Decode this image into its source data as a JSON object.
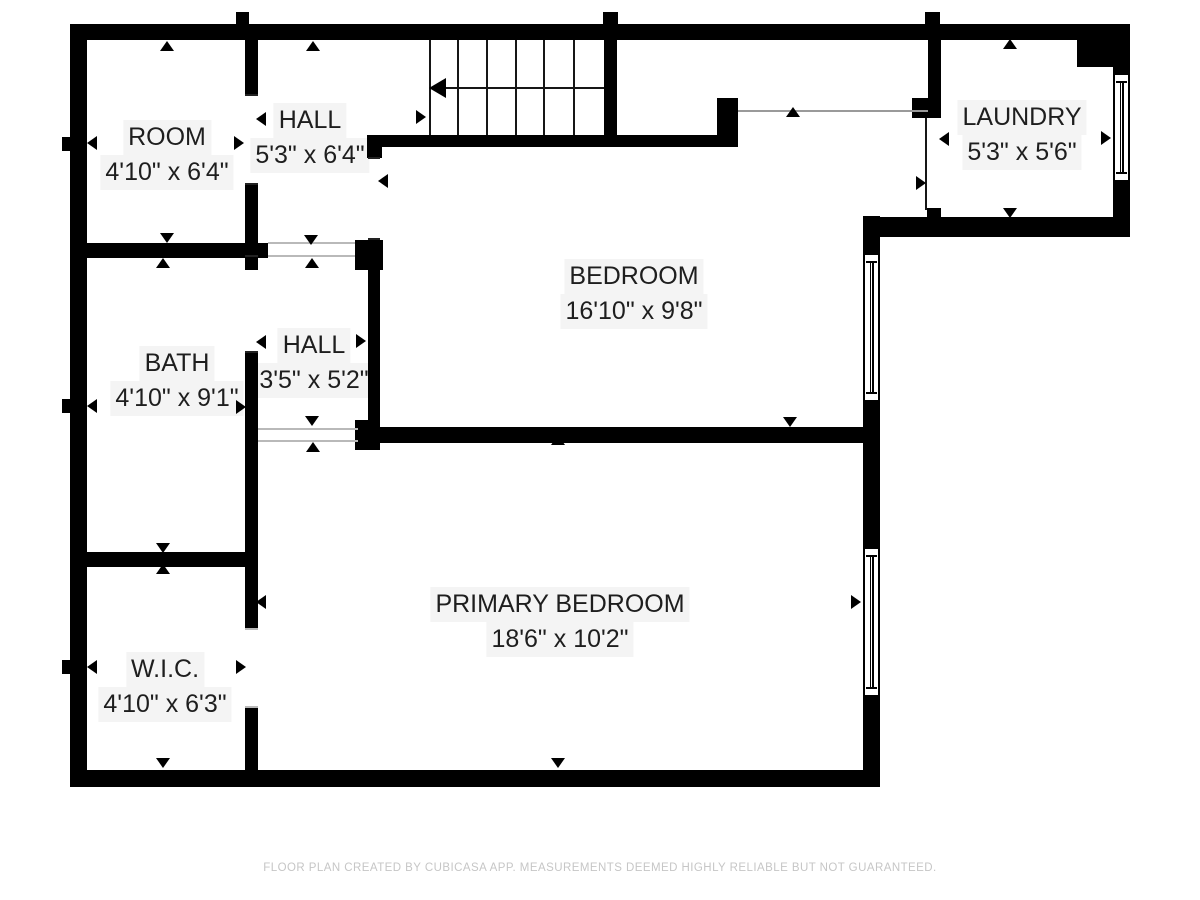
{
  "canvas": {
    "width": 1200,
    "height": 900,
    "background": "#ffffff",
    "wall_color": "#000000",
    "label_color": "#1e1e1e",
    "muted_color": "#c6c6c6"
  },
  "footer": {
    "text": "FLOOR PLAN CREATED BY CUBICASA APP. MEASUREMENTS DEEMED HIGHLY RELIABLE BUT NOT GUARANTEED.",
    "y": 862
  },
  "rooms": [
    {
      "id": "room",
      "name": "ROOM",
      "dims": "4'10\" x 6'4\"",
      "cx": 167,
      "cy": 155
    },
    {
      "id": "hall-upper",
      "name": "HALL",
      "dims": "5'3\" x 6'4\"",
      "cx": 310,
      "cy": 138
    },
    {
      "id": "laundry",
      "name": "LAUNDRY",
      "dims": "5'3\" x 5'6\"",
      "cx": 1022,
      "cy": 135
    },
    {
      "id": "bedroom",
      "name": "BEDROOM",
      "dims": "16'10\" x 9'8\"",
      "cx": 634,
      "cy": 294
    },
    {
      "id": "bath",
      "name": "BATH",
      "dims": "4'10\" x 9'1\"",
      "cx": 177,
      "cy": 381
    },
    {
      "id": "hall-lower",
      "name": "HALL",
      "dims": "3'5\" x 5'2\"",
      "cx": 314,
      "cy": 363
    },
    {
      "id": "wic",
      "name": "W.I.C.",
      "dims": "4'10\" x 6'3\"",
      "cx": 165,
      "cy": 687
    },
    {
      "id": "primary-bedroom",
      "name": "PRIMARY BEDROOM",
      "dims": "18'6\" x 10'2\"",
      "cx": 560,
      "cy": 622
    }
  ],
  "walls": [
    {
      "x": 70,
      "y": 24,
      "w": 1060,
      "h": 16
    },
    {
      "x": 70,
      "y": 24,
      "w": 17,
      "h": 763
    },
    {
      "x": 70,
      "y": 770,
      "w": 810,
      "h": 17
    },
    {
      "x": 863,
      "y": 216,
      "w": 17,
      "h": 554
    },
    {
      "x": 863,
      "y": 217,
      "w": 267,
      "h": 20
    },
    {
      "x": 1113,
      "y": 40,
      "w": 17,
      "h": 197
    },
    {
      "x": 1077,
      "y": 40,
      "w": 53,
      "h": 27
    },
    {
      "x": 245,
      "y": 40,
      "w": 13,
      "h": 55
    },
    {
      "x": 245,
      "y": 185,
      "w": 13,
      "h": 85
    },
    {
      "x": 70,
      "y": 243,
      "w": 198,
      "h": 15
    },
    {
      "x": 355,
      "y": 240,
      "w": 28,
      "h": 30
    },
    {
      "x": 245,
      "y": 353,
      "w": 13,
      "h": 214
    },
    {
      "x": 70,
      "y": 552,
      "w": 188,
      "h": 15
    },
    {
      "x": 245,
      "y": 567,
      "w": 13,
      "h": 63
    },
    {
      "x": 245,
      "y": 708,
      "w": 13,
      "h": 79
    },
    {
      "x": 368,
      "y": 240,
      "w": 12,
      "h": 187
    },
    {
      "x": 367,
      "y": 135,
      "w": 15,
      "h": 23
    },
    {
      "x": 367,
      "y": 135,
      "w": 350,
      "h": 12
    },
    {
      "x": 604,
      "y": 40,
      "w": 13,
      "h": 107
    },
    {
      "x": 717,
      "y": 98,
      "w": 21,
      "h": 49
    },
    {
      "x": 928,
      "y": 40,
      "w": 13,
      "h": 58
    },
    {
      "x": 912,
      "y": 98,
      "w": 29,
      "h": 20
    },
    {
      "x": 358,
      "y": 427,
      "w": 505,
      "h": 16
    },
    {
      "x": 355,
      "y": 420,
      "w": 25,
      "h": 30
    },
    {
      "x": 927,
      "y": 208,
      "w": 14,
      "h": 9
    },
    {
      "x": 236,
      "y": 12,
      "w": 13,
      "h": 12
    },
    {
      "x": 603,
      "y": 12,
      "w": 15,
      "h": 12
    },
    {
      "x": 925,
      "y": 12,
      "w": 15,
      "h": 12
    },
    {
      "x": 62,
      "y": 137,
      "w": 8,
      "h": 14
    },
    {
      "x": 62,
      "y": 399,
      "w": 8,
      "h": 14
    },
    {
      "x": 62,
      "y": 660,
      "w": 8,
      "h": 14
    }
  ],
  "lines": [
    {
      "x": 925,
      "y": 118,
      "w": 2,
      "h": 92,
      "c": "#161616"
    },
    {
      "x": 245,
      "y": 94,
      "w": 13,
      "h": 2,
      "c": "#222222"
    },
    {
      "x": 245,
      "y": 183,
      "w": 13,
      "h": 2,
      "c": "#222222"
    },
    {
      "x": 245,
      "y": 255,
      "w": 13,
      "h": 2,
      "c": "#222222"
    },
    {
      "x": 245,
      "y": 351,
      "w": 13,
      "h": 2,
      "c": "#222222"
    },
    {
      "x": 368,
      "y": 157,
      "w": 12,
      "h": 2,
      "c": "#222222"
    },
    {
      "x": 368,
      "y": 238,
      "w": 12,
      "h": 2,
      "c": "#222222"
    }
  ],
  "open_edges": [
    {
      "x": 268,
      "y": 242,
      "w": 87,
      "h": 2,
      "c": "#b9b9b9"
    },
    {
      "x": 268,
      "y": 255,
      "w": 87,
      "h": 2,
      "c": "#b9b9b9"
    },
    {
      "x": 258,
      "y": 428,
      "w": 100,
      "h": 2,
      "c": "#b9b9b9"
    },
    {
      "x": 258,
      "y": 440,
      "w": 100,
      "h": 2,
      "c": "#b9b9b9"
    },
    {
      "x": 738,
      "y": 110,
      "w": 190,
      "h": 2,
      "c": "#9a9a9a"
    },
    {
      "x": 245,
      "y": 628,
      "w": 13,
      "h": 2,
      "c": "#b9b9b9"
    },
    {
      "x": 245,
      "y": 706,
      "w": 13,
      "h": 2,
      "c": "#b9b9b9"
    }
  ],
  "windows": [
    {
      "x": 1113,
      "y": 73,
      "w": 17,
      "h": 109
    },
    {
      "x": 863,
      "y": 253,
      "w": 17,
      "h": 149
    },
    {
      "x": 863,
      "y": 547,
      "w": 17,
      "h": 150
    }
  ],
  "stairs": {
    "x": 429,
    "y": 40,
    "w": 175,
    "h": 95,
    "treads": [
      457,
      486,
      515,
      543,
      573
    ],
    "arrow_y": 88,
    "arrow_x1": 429,
    "arrow_x2": 604
  },
  "arrows": [
    {
      "x": 167,
      "y": 46,
      "d": "up"
    },
    {
      "x": 167,
      "y": 238,
      "d": "down"
    },
    {
      "x": 92,
      "y": 143,
      "d": "left"
    },
    {
      "x": 239,
      "y": 143,
      "d": "right"
    },
    {
      "x": 313,
      "y": 46,
      "d": "up"
    },
    {
      "x": 311,
      "y": 240,
      "d": "down"
    },
    {
      "x": 261,
      "y": 119,
      "d": "left"
    },
    {
      "x": 421,
      "y": 117,
      "d": "right"
    },
    {
      "x": 1010,
      "y": 44,
      "d": "up"
    },
    {
      "x": 1010,
      "y": 213,
      "d": "down"
    },
    {
      "x": 944,
      "y": 139,
      "d": "left"
    },
    {
      "x": 1106,
      "y": 138,
      "d": "right"
    },
    {
      "x": 793,
      "y": 112,
      "d": "up"
    },
    {
      "x": 790,
      "y": 422,
      "d": "down"
    },
    {
      "x": 383,
      "y": 181,
      "d": "left"
    },
    {
      "x": 921,
      "y": 183,
      "d": "right"
    },
    {
      "x": 163,
      "y": 263,
      "d": "up"
    },
    {
      "x": 163,
      "y": 548,
      "d": "down"
    },
    {
      "x": 92,
      "y": 406,
      "d": "left"
    },
    {
      "x": 241,
      "y": 407,
      "d": "right"
    },
    {
      "x": 312,
      "y": 263,
      "d": "up"
    },
    {
      "x": 312,
      "y": 421,
      "d": "down"
    },
    {
      "x": 261,
      "y": 342,
      "d": "left"
    },
    {
      "x": 361,
      "y": 341,
      "d": "right"
    },
    {
      "x": 163,
      "y": 569,
      "d": "up"
    },
    {
      "x": 163,
      "y": 763,
      "d": "down"
    },
    {
      "x": 92,
      "y": 667,
      "d": "left"
    },
    {
      "x": 241,
      "y": 667,
      "d": "right"
    },
    {
      "x": 558,
      "y": 440,
      "d": "up"
    },
    {
      "x": 558,
      "y": 763,
      "d": "down"
    },
    {
      "x": 261,
      "y": 602,
      "d": "left"
    },
    {
      "x": 856,
      "y": 602,
      "d": "right"
    },
    {
      "x": 313,
      "y": 447,
      "d": "up"
    }
  ]
}
